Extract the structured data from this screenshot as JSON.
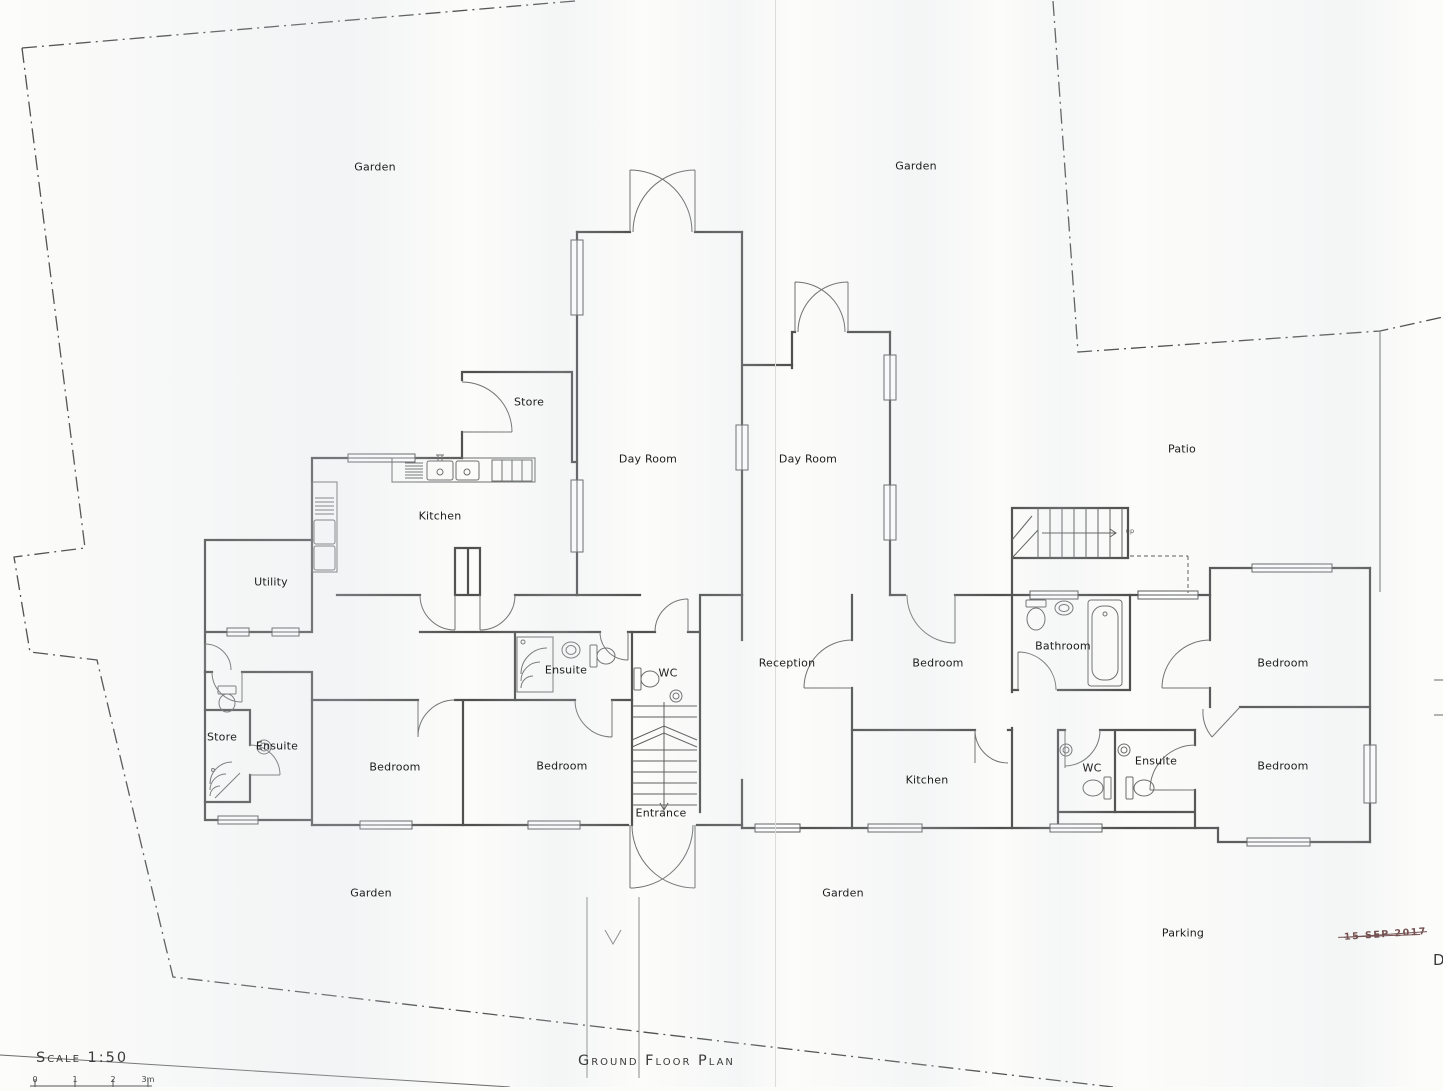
{
  "titles": {
    "scale": "Scale 1:50",
    "plan": "Ground Floor Plan"
  },
  "scale_bar": {
    "ticks": [
      {
        "text": "0",
        "x": 35
      },
      {
        "text": "1",
        "x": 75
      },
      {
        "text": "2",
        "x": 113
      },
      {
        "text": "3m",
        "x": 148
      }
    ]
  },
  "stamp": {
    "text": "15 SEP 2017",
    "color": "#5e3434"
  },
  "edge_letter": "D",
  "colors": {
    "ink": "#545454",
    "paper": "#fcfcfa",
    "stamp": "#5e3434"
  },
  "labels": [
    {
      "name": "garden-top-left",
      "text": "Garden",
      "x": 375,
      "y": 167
    },
    {
      "name": "garden-top-right",
      "text": "Garden",
      "x": 916,
      "y": 166
    },
    {
      "name": "store-top",
      "text": "Store",
      "x": 529,
      "y": 402
    },
    {
      "name": "day-room-left",
      "text": "Day Room",
      "x": 648,
      "y": 459
    },
    {
      "name": "day-room-right",
      "text": "Day Room",
      "x": 808,
      "y": 459
    },
    {
      "name": "patio",
      "text": "Patio",
      "x": 1182,
      "y": 449
    },
    {
      "name": "kitchen-main",
      "text": "Kitchen",
      "x": 440,
      "y": 516
    },
    {
      "name": "utility",
      "text": "Utility",
      "x": 271,
      "y": 582
    },
    {
      "name": "ensuite-mid",
      "text": "Ensuite",
      "x": 566,
      "y": 670
    },
    {
      "name": "wc-mid",
      "text": "WC",
      "x": 668,
      "y": 673
    },
    {
      "name": "reception",
      "text": "Reception",
      "x": 787,
      "y": 663
    },
    {
      "name": "bedroom-right-top",
      "text": "Bedroom",
      "x": 938,
      "y": 663
    },
    {
      "name": "bathroom",
      "text": "Bathroom",
      "x": 1063,
      "y": 646
    },
    {
      "name": "bedroom-far-right-top",
      "text": "Bedroom",
      "x": 1283,
      "y": 663
    },
    {
      "name": "store-block",
      "text": "Store",
      "x": 222,
      "y": 737
    },
    {
      "name": "ensuite-block",
      "text": "Ensuite",
      "x": 277,
      "y": 746
    },
    {
      "name": "bedroom-left-1",
      "text": "Bedroom",
      "x": 395,
      "y": 767
    },
    {
      "name": "bedroom-left-2",
      "text": "Bedroom",
      "x": 562,
      "y": 766
    },
    {
      "name": "kitchen-right",
      "text": "Kitchen",
      "x": 927,
      "y": 780
    },
    {
      "name": "wc-right",
      "text": "WC",
      "x": 1092,
      "y": 768
    },
    {
      "name": "ensuite-right",
      "text": "Ensuite",
      "x": 1156,
      "y": 761
    },
    {
      "name": "bedroom-far-right-bottom",
      "text": "Bedroom",
      "x": 1283,
      "y": 766
    },
    {
      "name": "entrance",
      "text": "Entrance",
      "x": 661,
      "y": 813
    },
    {
      "name": "garden-bottom-left",
      "text": "Garden",
      "x": 371,
      "y": 893
    },
    {
      "name": "garden-bottom-center",
      "text": "Garden",
      "x": 843,
      "y": 893
    },
    {
      "name": "parking",
      "text": "Parking",
      "x": 1183,
      "y": 933
    },
    {
      "name": "stairs-up-note",
      "text": "up",
      "x": 1130,
      "y": 531,
      "tiny": true
    }
  ]
}
